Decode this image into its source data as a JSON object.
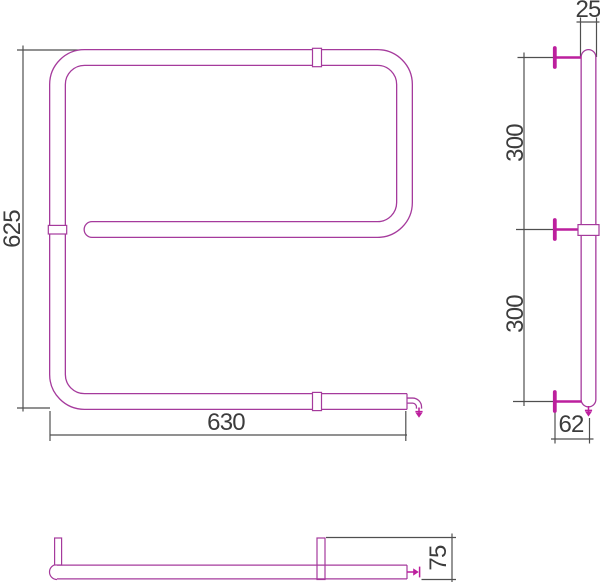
{
  "drawing": {
    "kind": "towel-rail technical dimension drawing, three views (front, side, bottom)",
    "dimensions": {
      "front_height": "625",
      "front_width": "630",
      "side_pipe_width": "25",
      "side_upper_span": "300",
      "side_lower_span": "300",
      "side_bottom_offset": "62",
      "bottom_depth": "75"
    },
    "colors": {
      "pipe": "#a53a9c",
      "bracket": "#bc1f9d",
      "dimension_line": "#4f4f4f",
      "dimension_text": "#3c3c3c",
      "background": "#ffffff"
    }
  }
}
